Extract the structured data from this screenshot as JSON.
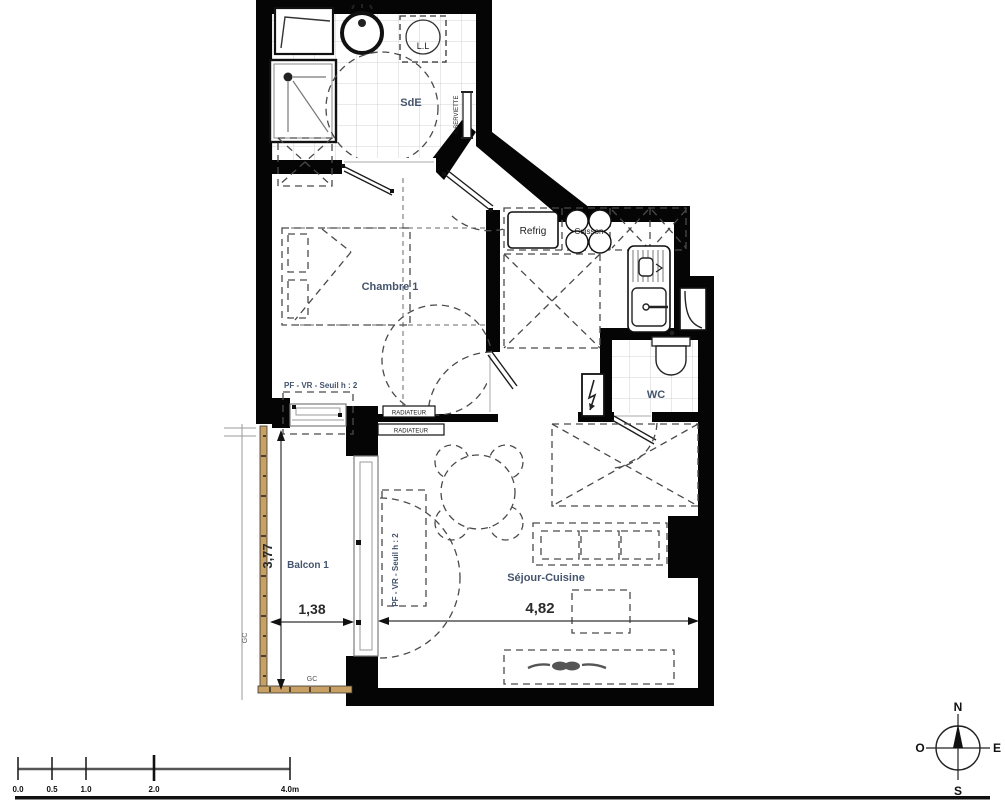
{
  "plan": {
    "rooms": {
      "sde": "SdE",
      "chambre": "Chambre 1",
      "wc": "WC",
      "sejour": "Séjour-Cuisine",
      "balcon": "Balcon 1"
    },
    "equipment": {
      "washing_machine": "L.L",
      "fridge": "Refrig",
      "hob": "Cuisson",
      "towel_rail": "S.SERVIETTE",
      "radiator": "RADIATEUR",
      "window_spec": "PF - VR - Seuil h : 2",
      "guardrail": "GC"
    },
    "dimensions": {
      "balcon_depth": "3,77",
      "balcon_width": "1,38",
      "sejour_width": "4,82"
    }
  },
  "scale_bar": {
    "ticks": [
      "0.0",
      "0.5",
      "1.0",
      "2.0",
      "4.0m"
    ]
  },
  "compass": {
    "north": "N",
    "south": "S",
    "east": "E",
    "west": "O"
  },
  "colors": {
    "wall": "#050505",
    "room_label": "#44546d",
    "railing": "#c9a063",
    "dash": "#4a4a4a"
  }
}
